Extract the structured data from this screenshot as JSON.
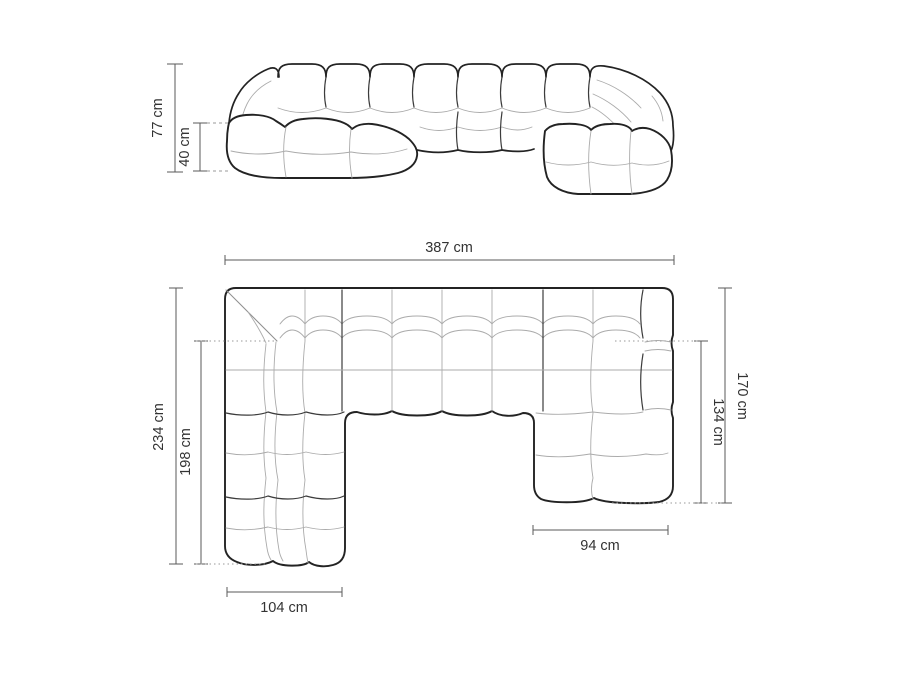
{
  "front_view": {
    "dims": {
      "total_height": "77 cm",
      "base_height": "40 cm"
    }
  },
  "plan_view": {
    "dims": {
      "total_width": "387 cm",
      "left_depth": "234 cm",
      "left_inner_depth": "198 cm",
      "right_depth": "170 cm",
      "right_inner_depth": "134 cm",
      "left_chaise_width": "104 cm",
      "right_chaise_width": "94 cm"
    }
  },
  "colors": {
    "background": "#ffffff",
    "outline": "#232323",
    "cushion_detail": "#ababab",
    "dimension_lines": "#5a5a5a",
    "label_text": "#333333"
  }
}
